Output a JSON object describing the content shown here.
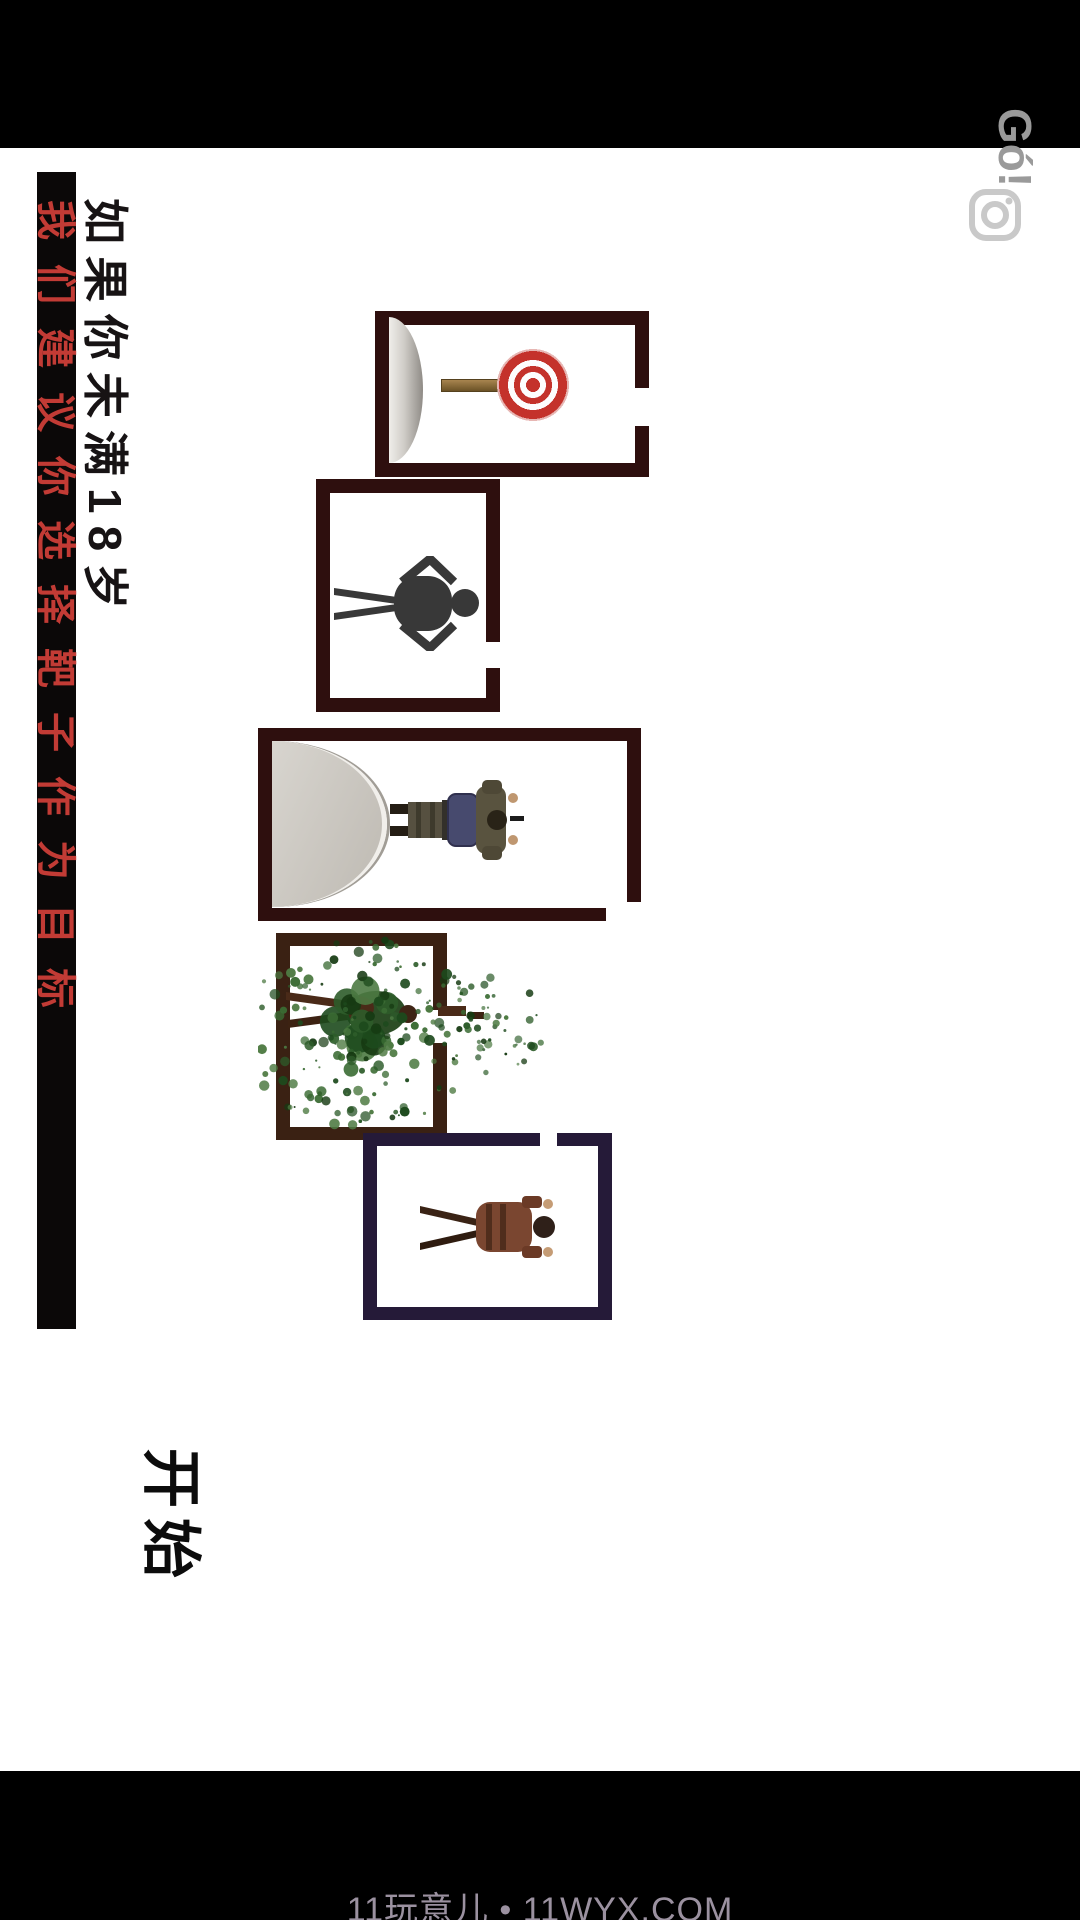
{
  "bottom_bar": {
    "site_text": "11玩意儿 • 11WYX.COM"
  },
  "overlay": {
    "logo_text": "Gó!",
    "camera_icon": "camera-record-icon"
  },
  "warning": {
    "age_text": "如果你未满18岁",
    "advice_text": "我们建议你选择靶子作为目标"
  },
  "menu": {
    "start_label": "开始"
  },
  "rooms": [
    {
      "id": "room-1",
      "target": "bullseye-target-on-stick"
    },
    {
      "id": "room-2",
      "target": "human-silhouette-target"
    },
    {
      "id": "room-3",
      "target": "prone-soldier"
    },
    {
      "id": "room-4",
      "target": "dead-soldier-green-splatter"
    },
    {
      "id": "room-5",
      "target": "standing-soldier"
    }
  ],
  "colors": {
    "wall_dark_maroon": "#2e0f0e",
    "wall_brown": "#3a2113",
    "wall_navy": "#251a38",
    "bullseye_red": "#c4322b",
    "splatter_green": "#2d5c2a",
    "warning_red_text": "#c23b35",
    "bottom_bar_text": "#9b91a0",
    "door_arc_gray": "#c9c5c0"
  }
}
